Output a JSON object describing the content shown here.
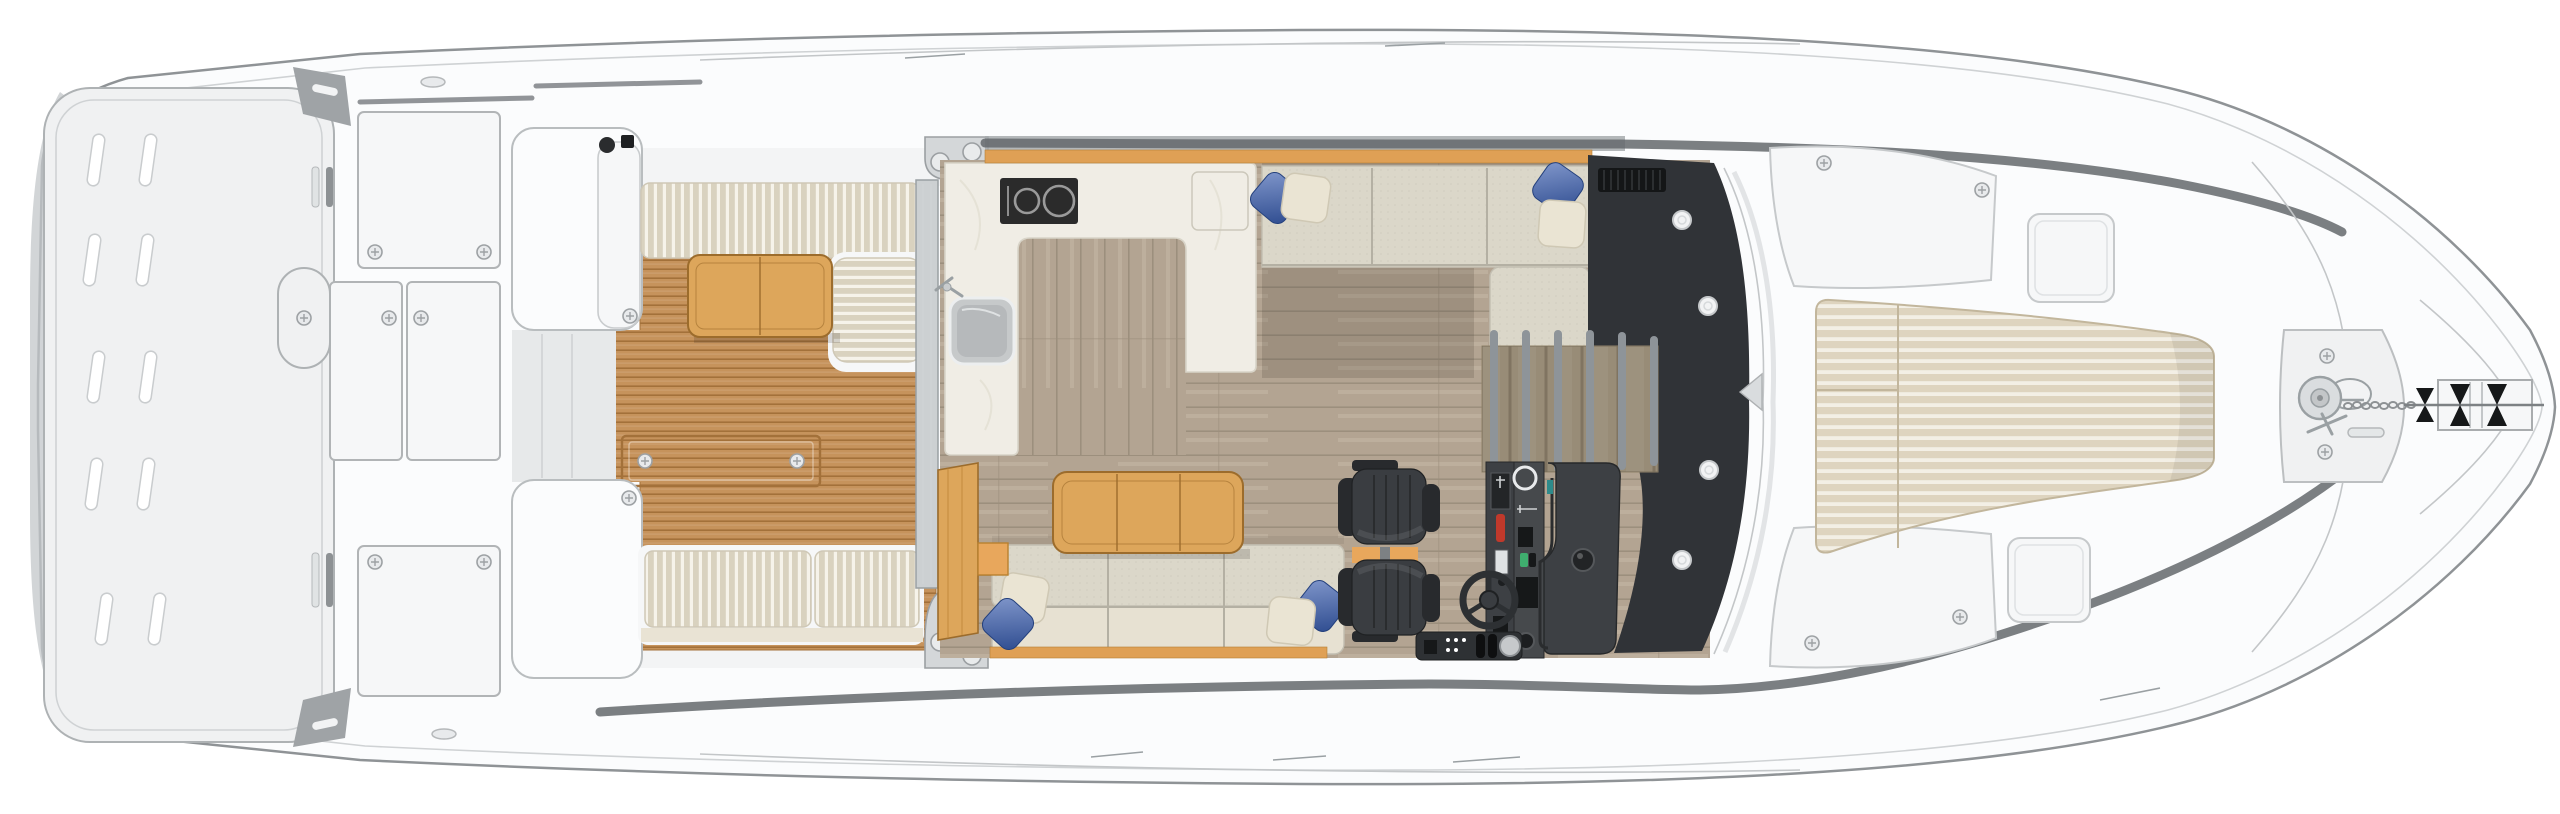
{
  "page": {
    "kind": "yacht-main-deck-floor-plan",
    "view": "top-down illustration, bow to the right, stern to the left",
    "visible_text": "none"
  },
  "colors": {
    "white": "#ffffff",
    "hull": "#fbfcfd",
    "hullLine": "#8f9396",
    "innerLine": "#cfd2d4",
    "deck": "#f3f4f5",
    "platform": "#f0f1f2",
    "panel": "#f6f7f8",
    "bandDark": "#64686c",
    "teak": "#c6935c",
    "teakLine": "#a3713a",
    "tableWood": "#dda65b",
    "tableLine": "#9c6c2c",
    "cushion": "#e7e1d2",
    "cushionSlat": "#d9d2bf",
    "benchFabric": "#dbd7c9",
    "benchLine": "#b4b0a3",
    "floor": "#b3a492",
    "floorLight": "#c5b7a5",
    "floorLine": "#9c8f7d",
    "marble": "#f0ede5",
    "cooktop": "#2b2b2b",
    "cooktopRing": "#9a9a9a",
    "sink": "#b6b9bb",
    "steel": "#c9ccce",
    "pillowBlue1": "#8298cc",
    "pillowBlue2": "#2c4a8e",
    "pillowCream": "#eae4d3",
    "dark": "#303337",
    "darkPanel": "#3d4044",
    "chair": "#3a3d41",
    "chairDark": "#282a2d",
    "accentOrange": "#e8a75c",
    "trimWood": "#dfa055",
    "stairWood": "#b4a58a",
    "railing": "#989ea3",
    "sunpad": "#ded4bf",
    "sunpadStripe": "#f3efe5",
    "sunpadLine": "#c2b69c",
    "green": "#3fae6e",
    "red": "#c0392b",
    "teal": "#2e8b8b"
  },
  "scene": {
    "areas": [
      {
        "name": "swim-platform",
        "items": [
          "drain-slot x10",
          "hull-side-shading"
        ]
      },
      {
        "name": "transom",
        "items": [
          "storage-locker x4",
          "door-handle-recess",
          "vent-slats x2",
          "emblem x2",
          "corner-vent x2"
        ]
      },
      {
        "name": "cockpit",
        "items": [
          "aft-bench-slatted",
          "forward-bench-slatted x2",
          "side-l-cushion",
          "teak-deck",
          "teak-table",
          "deck-hatch-with-screws",
          "wet-bar-module",
          "transom-walkthrough"
        ]
      },
      {
        "name": "galley",
        "items": [
          "u-shaped-counter",
          "two-burner-cooktop",
          "sink",
          "faucet",
          "aisle-floor",
          "cabinet-door-lines"
        ]
      },
      {
        "name": "salon",
        "items": [
          "port-bench-sofa",
          "starboard-sofa",
          "coffee-table",
          "pillow-blue x4",
          "pillow-cream x4",
          "wood-cabinet",
          "wood-step",
          "window-trim-wood"
        ]
      },
      {
        "name": "helm",
        "items": [
          "helm-seat x2",
          "seat-platform-orange",
          "steering-wheel",
          "instrument-columns",
          "joystick",
          "throttle-strip",
          "cup-holder-ring"
        ]
      },
      {
        "name": "companionway",
        "items": [
          "dark-windshield-dash",
          "vent-grille",
          "speaker x4",
          "stairs-down",
          "railing-bar x6",
          "wiper-notch"
        ]
      },
      {
        "name": "foredeck",
        "items": [
          "sunpad-striped",
          "access-panel x2",
          "deck-hatch x2",
          "bulwark-band x2"
        ]
      },
      {
        "name": "bow",
        "items": [
          "windlass",
          "anchor-chain",
          "chain-handle",
          "anchor-roller-unit",
          "mooring-slot",
          "screw x2",
          "panel-chevron"
        ]
      }
    ],
    "counts": {
      "drain_slots": 10,
      "burners": 2,
      "helm_seats": 2,
      "speakers": 4,
      "pillows_blue": 4,
      "pillows_cream": 4,
      "railing_bars": 6,
      "transom_lockers": 4
    }
  }
}
